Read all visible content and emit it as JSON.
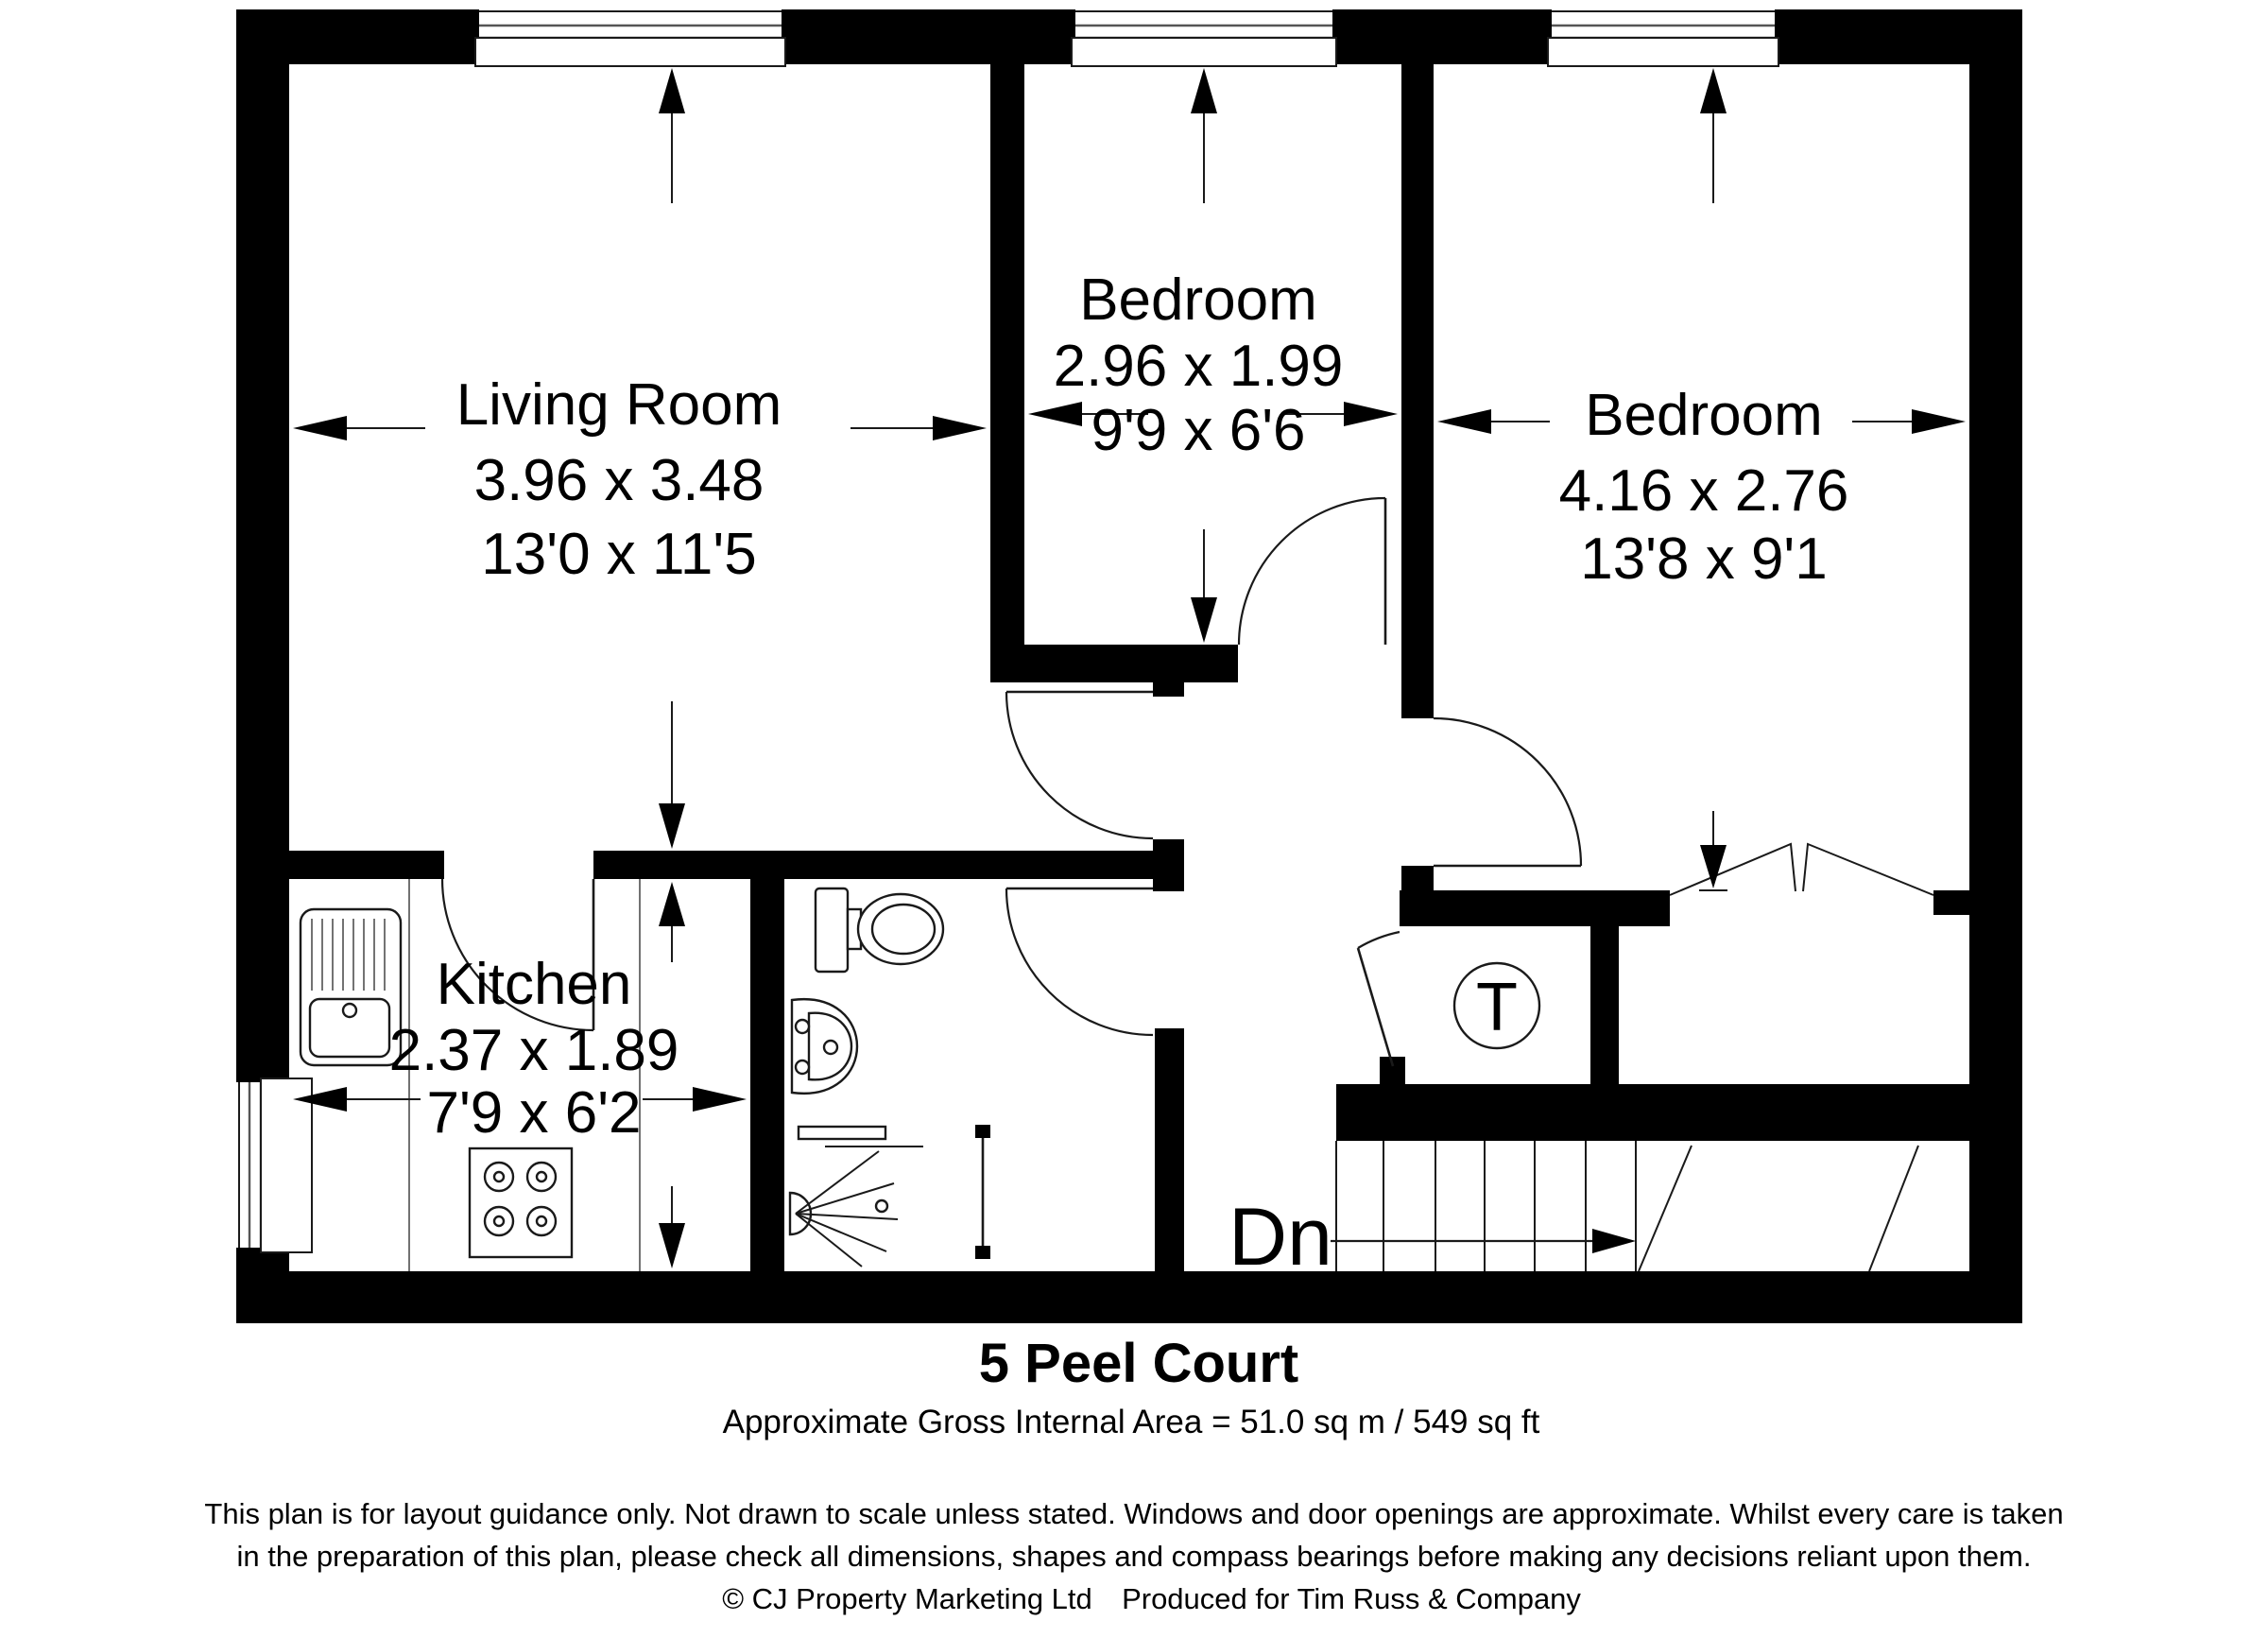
{
  "title": "5 Peel Court",
  "subtitle": "Approximate Gross Internal Area = 51.0 sq m / 549 sq ft",
  "disclaimer": {
    "line1": "This plan is for layout guidance only. Not drawn to scale unless stated. Windows and door openings are approximate. Whilst every care is taken",
    "line2": "in the preparation of this plan, please check all dimensions, shapes and compass bearings before making any decisions reliant upon them.",
    "copyright": "© CJ Property Marketing Ltd",
    "produced_for": "Produced for Tim Russ & Company"
  },
  "rooms": {
    "living_room": {
      "name": "Living Room",
      "size_metric": "3.96 x 3.48",
      "size_imperial": "13'0 x 11'5"
    },
    "bedroom_1": {
      "name": "Bedroom",
      "size_metric": "2.96 x 1.99",
      "size_imperial": "9'9 x 6'6"
    },
    "bedroom_2": {
      "name": "Bedroom",
      "size_metric": "4.16 x 2.76",
      "size_imperial": "13'8 x 9'1"
    },
    "kitchen": {
      "name": "Kitchen",
      "size_metric": "2.37 x 1.89",
      "size_imperial": "7'9 x 6'2"
    }
  },
  "annotations": {
    "stairs_down": "Dn",
    "tank_cupboard": "T"
  },
  "colors": {
    "walls": "#000000",
    "background": "#ffffff",
    "lines": "#1a1a1a"
  }
}
